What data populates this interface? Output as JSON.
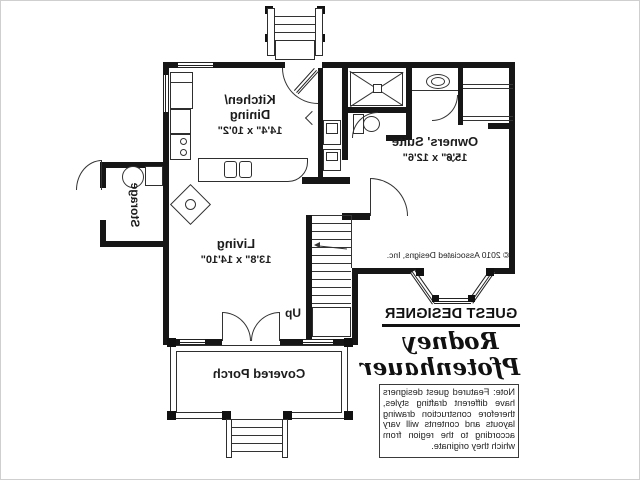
{
  "plan": {
    "rooms": [
      {
        "line1": "Kitchen/",
        "line2": "Dining",
        "dims": "14'4\" x 10'2\""
      },
      {
        "line1": "Owners' Suite",
        "dims": "15'6\" x 12'6\""
      },
      {
        "line1": "Living",
        "dims": "13'8\" x 14'10\""
      },
      {
        "line1": "Storage"
      },
      {
        "line1": "Covered Porch"
      }
    ],
    "stair_label": "Up",
    "copyright": "© 2010 Associated Designs, Inc."
  },
  "designer": {
    "heading": "GUEST DESIGNER",
    "name_line1": "Rodney",
    "name_line2": "Pfotenhauer",
    "note": "Note: Featured guest designers have different drafting styles, therefore construction drawing layouts and contents will vary according to the region from which they originate."
  },
  "colors": {
    "wall": "#161616",
    "line": "#2e2e2e",
    "background": "#ffffff"
  }
}
